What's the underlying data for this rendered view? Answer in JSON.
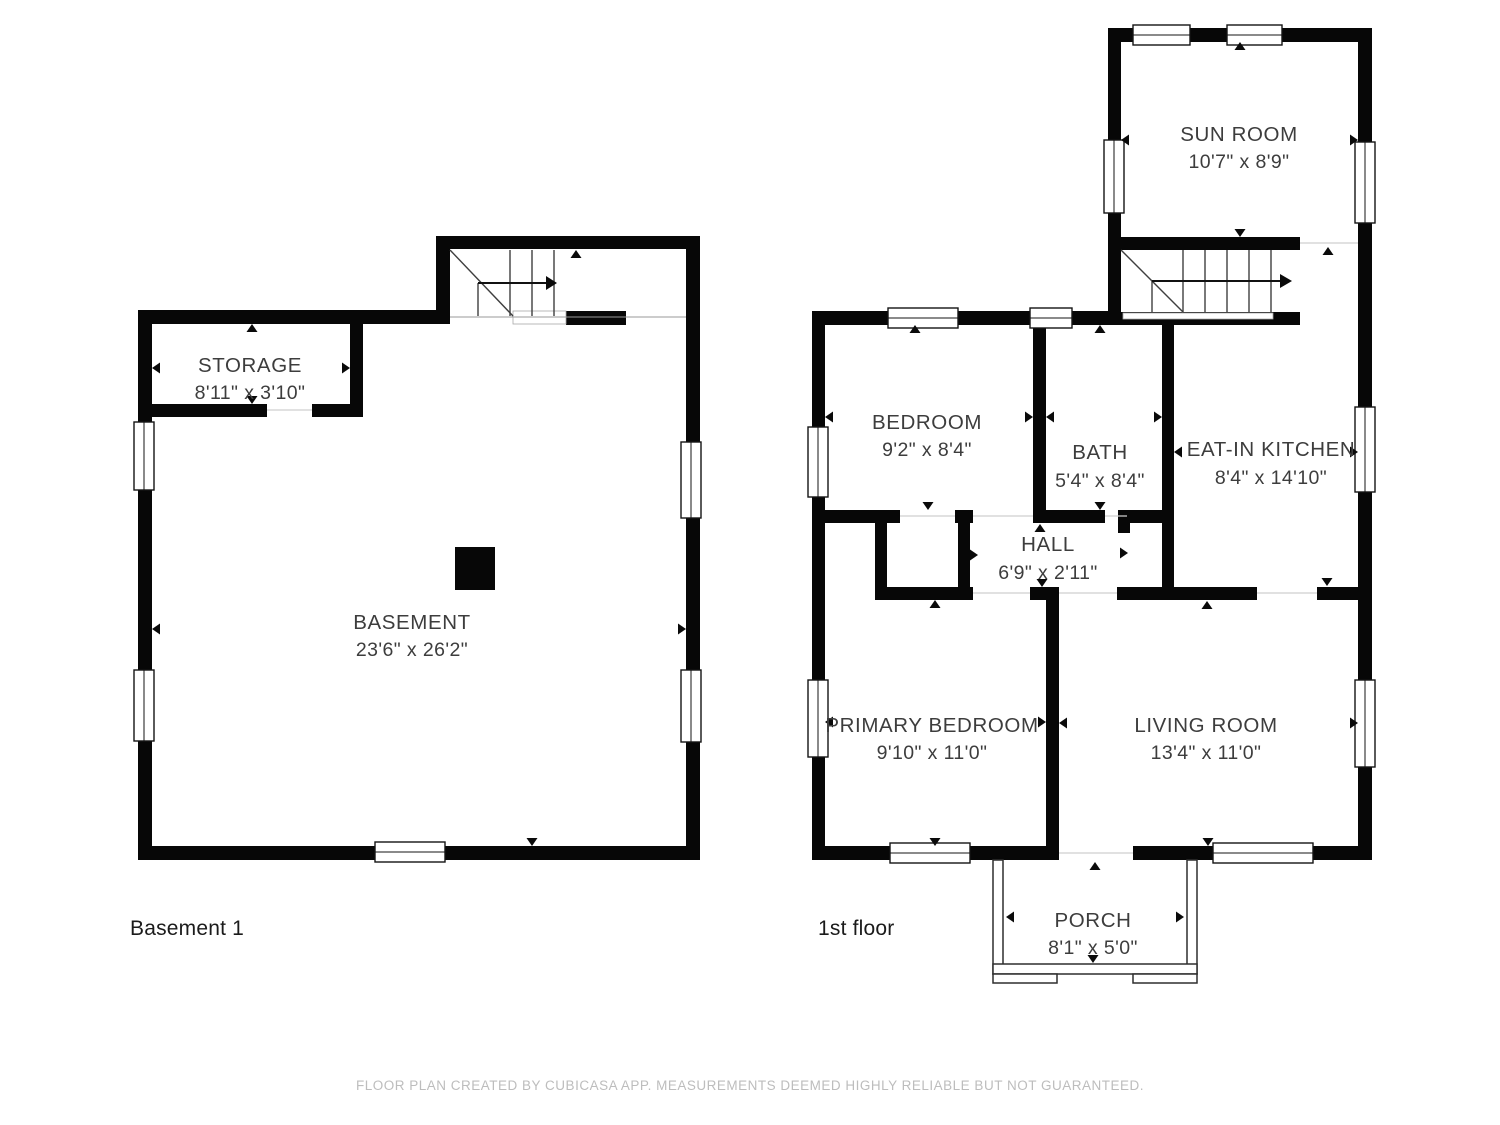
{
  "floors": {
    "basement": {
      "label": "Basement 1",
      "rooms": {
        "storage": {
          "name": "STORAGE",
          "dims": "8'11\" x 3'10\""
        },
        "basement": {
          "name": "BASEMENT",
          "dims": "23'6\" x 26'2\""
        }
      }
    },
    "first": {
      "label": "1st floor",
      "rooms": {
        "sun_room": {
          "name": "SUN ROOM",
          "dims": "10'7\" x 8'9\""
        },
        "bedroom": {
          "name": "BEDROOM",
          "dims": "9'2\" x 8'4\""
        },
        "bath": {
          "name": "BATH",
          "dims": "5'4\" x 8'4\""
        },
        "kitchen": {
          "name": "EAT-IN KITCHEN",
          "dims": "8'4\" x 14'10\""
        },
        "hall": {
          "name": "HALL",
          "dims": "6'9\" x 2'11\""
        },
        "primary": {
          "name": "PRIMARY BEDROOM",
          "dims": "9'10\" x 11'0\""
        },
        "living": {
          "name": "LIVING ROOM",
          "dims": "13'4\" x 11'0\""
        },
        "porch": {
          "name": "PORCH",
          "dims": "8'1\" x 5'0\""
        }
      }
    }
  },
  "footer": {
    "text": "FLOOR PLAN CREATED BY CUBICASA APP. MEASUREMENTS DEEMED HIGHLY RELIABLE BUT NOT GUARANTEED."
  }
}
